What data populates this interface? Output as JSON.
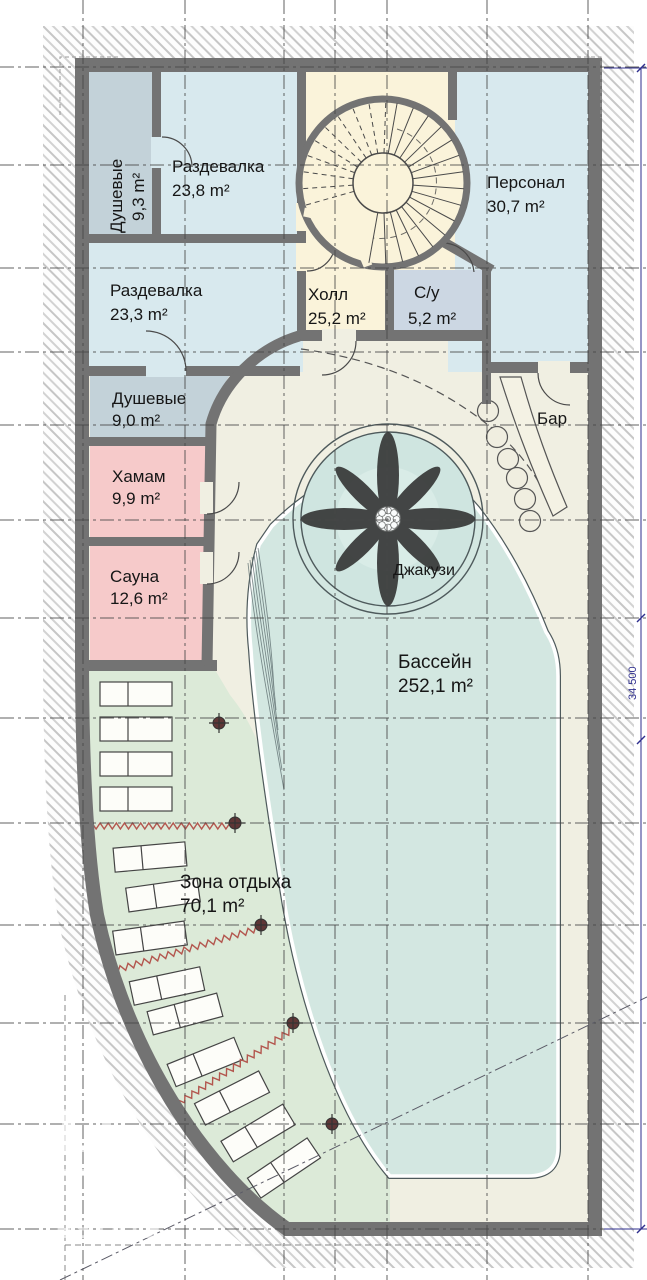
{
  "plan": {
    "rooms": [
      {
        "id": "dushevye-1",
        "name": "Душевые",
        "area": "9,3 m²"
      },
      {
        "id": "razdevalka-1",
        "name": "Раздевалка",
        "area": "23,8 m²"
      },
      {
        "id": "personal",
        "name": "Персонал",
        "area": "30,7 m²"
      },
      {
        "id": "razdevalka-2",
        "name": "Раздевалка",
        "area": "23,3 m²"
      },
      {
        "id": "kholl",
        "name": "Холл",
        "area": "25,2 m²"
      },
      {
        "id": "su",
        "name": "С/у",
        "area": "5,2 m²"
      },
      {
        "id": "dushevye-2",
        "name": "Душевые",
        "area": "9,0 m²"
      },
      {
        "id": "bar",
        "name": "Бар"
      },
      {
        "id": "khamam",
        "name": "Хамам",
        "area": "9,9 m²"
      },
      {
        "id": "sauna",
        "name": "Сауна",
        "area": "12,6 m²"
      },
      {
        "id": "jacuzzi",
        "name": "Джакузи"
      },
      {
        "id": "bassein",
        "name": "Бассейн",
        "area": "252,1 m²"
      },
      {
        "id": "zona-otdykha",
        "name": "Зона отдыха",
        "area": "70,1 m²"
      }
    ],
    "dimensions": {
      "right_side_total": "34 500"
    },
    "watermark": {
      "line1": "LE",
      "line2": "TO",
      "line3": "ESTATE"
    },
    "colors": {
      "wall": "#737373",
      "changing_room_fill": "#d8e9ee",
      "shower_fill": "#c3d2d9",
      "wc_fill": "#ccd7e3",
      "hall_fill": "#faf3da",
      "deck_fill": "#f0efe2",
      "sauna_fill": "#f6caca",
      "pool_fill": "#d3e7e1",
      "rest_zone_fill": "#dcead8",
      "heater_zigzag": "#b3564e",
      "dimension_text": "#2e2e8e"
    }
  }
}
